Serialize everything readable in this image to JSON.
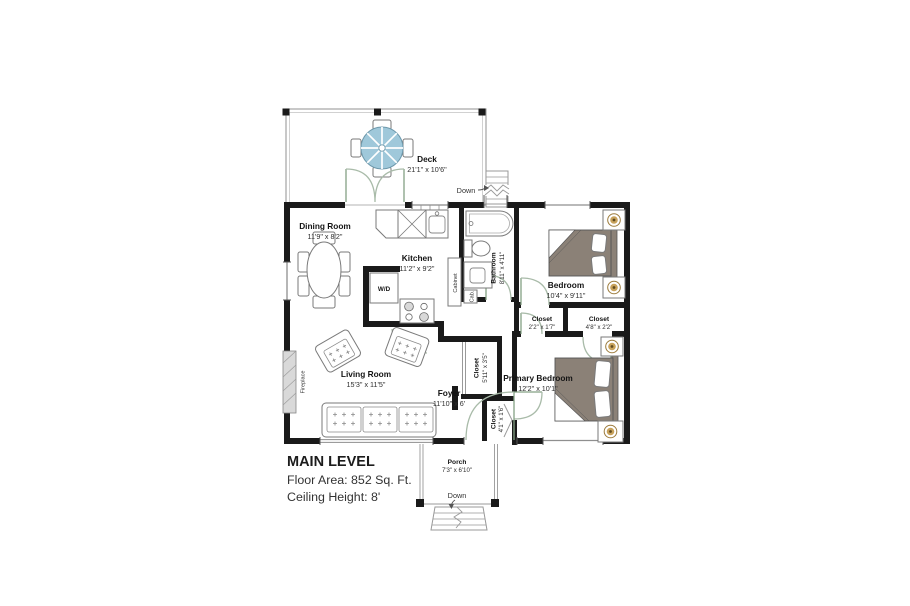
{
  "plan": {
    "title_block": {
      "title": "MAIN LEVEL",
      "floor_area": "Floor Area: 852 Sq. Ft.",
      "ceiling_height": "Ceiling Height: 8'"
    },
    "rooms": {
      "deck": {
        "name": "Deck",
        "dims": "21'1\" x 10'6\""
      },
      "dining_room": {
        "name": "Dining Room",
        "dims": "11'9\" x 8'2\""
      },
      "kitchen": {
        "name": "Kitchen",
        "dims": "11'2\" x 9'2\""
      },
      "bathroom": {
        "name": "Bathroom",
        "dims": "8'11\" x 4'11\""
      },
      "bedroom": {
        "name": "Bedroom",
        "dims": "10'4\" x 9'11\""
      },
      "closet_hall": {
        "name": "Closet",
        "dims": "2'2\" x 1'7\""
      },
      "closet_bedroom": {
        "name": "Closet",
        "dims": "4'8\" x 2'2\""
      },
      "closet_foyer": {
        "name": "Closet",
        "dims": "5'11\" x 3'5\""
      },
      "closet_entry": {
        "name": "Closet",
        "dims": "4'1\" x 1'6\""
      },
      "living_room": {
        "name": "Living Room",
        "dims": "15'3\" x 11'5\""
      },
      "foyer": {
        "name": "Foyer",
        "dims": "11'10\" x 6'"
      },
      "primary_bedroom": {
        "name": "Primary Bedroom",
        "dims": "12'2\" x 10'1\""
      },
      "porch": {
        "name": "Porch",
        "dims": "7'3\" x 6'10\""
      }
    },
    "fixtures": {
      "washer_dryer": "W/D",
      "cabinet": "Cabinet",
      "cab": "Cab.",
      "fireplace": "Fireplace"
    },
    "stairs": {
      "deck_down": "Down",
      "porch_down": "Down"
    },
    "colors": {
      "wall": "#1a1a1a",
      "thin_line": "#8f8f8f",
      "door_swing": "#a9bba9",
      "umbrella": "#9fc8da",
      "bed": "#8b8177",
      "lamp": "#c8a25b",
      "fireplace": "#d9d9d9"
    }
  }
}
